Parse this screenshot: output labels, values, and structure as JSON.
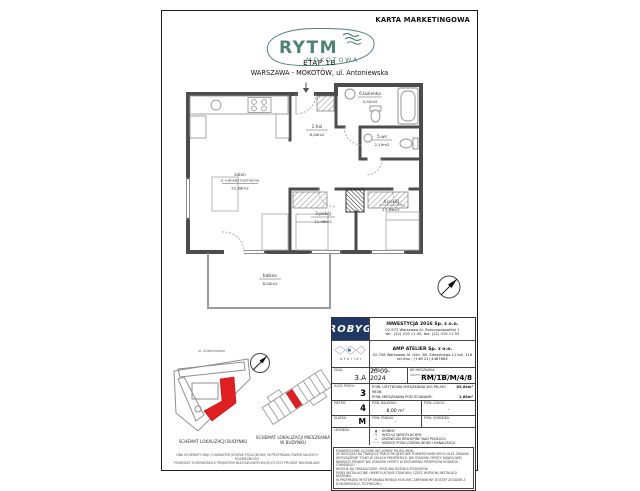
{
  "header": {
    "doc_type": "KARTA MARKETINGOWA",
    "logo_line1": "RYTM",
    "logo_line2": "MOKOTOWA",
    "etap": "ETAP 1B",
    "location": "WARSZAWA - MOKOTÓW, ul. Antoniewska"
  },
  "plan": {
    "rooms": [
      {
        "name": "1.hol",
        "area": "8,00m2"
      },
      {
        "name": "salon",
        "name2": "2.+aneks kuchenny",
        "area": "22,68m2"
      },
      {
        "name": "3.pokój",
        "area": "11,96m2"
      },
      {
        "name": "4.pokój",
        "area": "13,69m2"
      },
      {
        "name": "5.wc",
        "area": "2,19m2"
      },
      {
        "name": "6.łazienka",
        "area": "4,92m2"
      },
      {
        "name": "balkon",
        "area": "8,00m2"
      }
    ]
  },
  "schematics": {
    "street": "ul. Antoniewska",
    "building_caption": "SCHEMAT LOKALIZACJI BUDYNKU",
    "apartment_caption": "SCHEMAT LOKALIZACJI MIESZKANIA W BUDYNKU",
    "disclaimer1": "OBA SCHEMATY MAJĄ CHARAKTER JEDYNIE POGLĄDOWY. W PRZYPADKU EWENTUALNYCH ROZBIEŻNOŚCI",
    "disclaimer2": "POMIĘDZY SCHEMATAMI A PROJEKTEM BUDOWLANYM WIĄŻĄCY JEST PROJEKT BUDOWLANY."
  },
  "table": {
    "developer": {
      "logo": "ROBYG",
      "name": "INWESTYCJA 2016 Sp. z o.o.",
      "address1": "02-972 Warszawa Al. Rzeczypospolitej 1",
      "address2": "tel.: (22) 419 11 00, fax: (22) 419 11 03"
    },
    "architect": {
      "logo": "atelier",
      "name": "AMP ATELIER Sp. z o.o.",
      "address1": "02-758 Warszawa  Al. Gen. Wł. Sikorskiego 11 lok. 116",
      "address2": "tel./fax : (+48 22) 4467864"
    },
    "faza_label": "FAZA:",
    "faza": "3.A",
    "data_label": "DATA:",
    "data": "20-09-2024",
    "nr_label": "NR MIESZKANIA",
    "nr_sublabel": "INWESTYCYJNY/BUDOWLANY",
    "nr": "RM/1B/M/4/8",
    "rooms_label": "ILOŚĆ POKOI:",
    "rooms": "3",
    "area_rows": [
      {
        "label": "POW. UŻYTKOWA MIESZKANIA WG PN-ISO 9836:",
        "value": "63,64m²"
      },
      {
        "label": "POW. MIESZKANIA POD ŚCIANAMI:",
        "value": "1,68m²"
      },
      {
        "label": "ŁĄCZNA POWIERZCHNIA MIESZKANIA:",
        "value": "65,32m²"
      }
    ],
    "floor_label": "PIĘTRO:",
    "floor": "4",
    "balkon_label": "POW. BALKONU:",
    "balkon": "8,00 m²",
    "loggia_label": "POW. LOGGII:",
    "loggia": "-",
    "klatka_label": "KLATKA:",
    "klatka": "M",
    "taras_label": "POW. TARASU:",
    "taras": "-",
    "ogrodek_label": "POW. OGRÓDKA:",
    "ogrodek": "-",
    "legend_label": "LEGENDA:",
    "legend_syms": [
      "▮",
      "→·",
      "▫",
      "─◦─"
    ],
    "legend_items": [
      "KOMINY",
      "WYCIĄG WENTYLACYJNY",
      "DRZWICZKI REWIZYJNE NAD PODŁOGĄ",
      "MIEJSCE PODŁĄCZENIA WODY I KANALIZACJI"
    ],
    "footnotes": [
      "POWIERZCHNIE LICZONE WG NORMY PN-ISO 9836.",
      "ZE WZGLĘDU NA TRWAJĄCE PRACE PROJEKTOWE POWIERZCHNIE MOGĄ ULEC ZMIANIE.",
      "WYPOSAŻENIE TYLKO W CELACH PREZENTACJI. NIE STANOWI OFERTY HANDLOWEJ.",
      "NINIEJSZY PROJEKT NIE STANOWI OFERTY W ROZUMIENIU PRZEPISÓW KODEKSU CYWILNEGO.",
      "WYJŚCIE NA TARAS/LOGGIĘ: MOŻLIWA RÓŻNICA POZIOMÓW.",
      "PIONY INSTALACYJNE I WENTYLACYJNE STANOWIĄ CZĘŚĆ WSPÓLNĄ INSTALACJI BUDYNKU.",
      "W PRZYPADKU WYSTĘPOWANIA REWIZJI MUSI BYĆ ZAPEWNIONY DOSTĘP ZGODNIE Z DOKUMENTACJĄ TECHNICZNĄ."
    ]
  },
  "colors": {
    "brand_green": "#4e8272",
    "robyg_navy": "#203864",
    "highlight_red": "#e02020",
    "wall_gray": "#4c4c4c"
  }
}
